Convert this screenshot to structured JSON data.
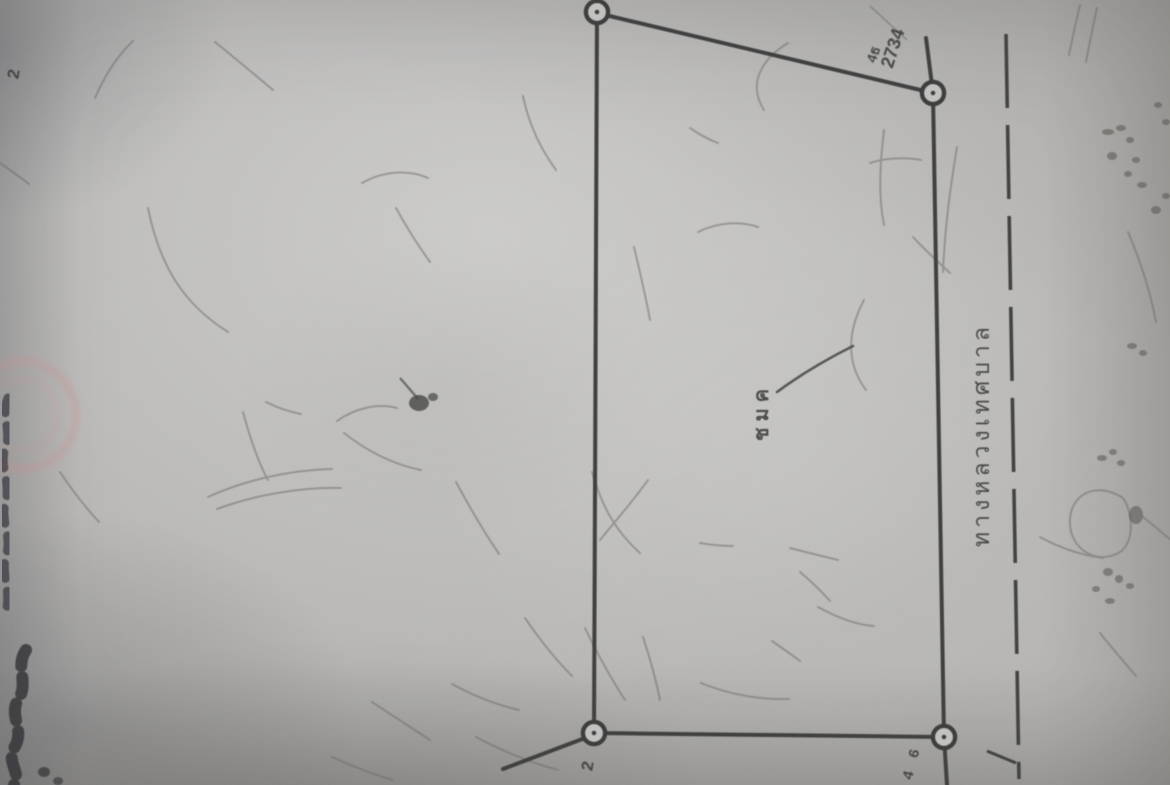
{
  "photo": {
    "description": "Photograph of a Thai cadastral land-survey sketch (plot boundary diagram), page rotated 90 degrees counter-clockwise",
    "paper_color": "#b9b8b6",
    "ink_color": "#3d3d3d",
    "pencil_color": "#6a6966",
    "stamp_color": "#c98f8f"
  },
  "diagram": {
    "road_label": "ทางหลวงเทศบาล",
    "road_line_style": "dashed",
    "parcel_pointer_label": "ชมค",
    "boundary_post_label_line1": "4ธ",
    "boundary_post_label_line2": "2734",
    "corner_number_bottom_left": "2",
    "corner_number_bottom_right": "4 6",
    "edge_number_top_left": "2",
    "corner_markers_count": "4"
  },
  "annotations": {
    "left_edge_handwriting": "illegible handwriting, cut off at left edge",
    "bottom_left_handwriting": "illegible handwriting, cut off at bottom-left edge",
    "stamp": "faint red circular stamp impression, partially visible at left edge"
  }
}
